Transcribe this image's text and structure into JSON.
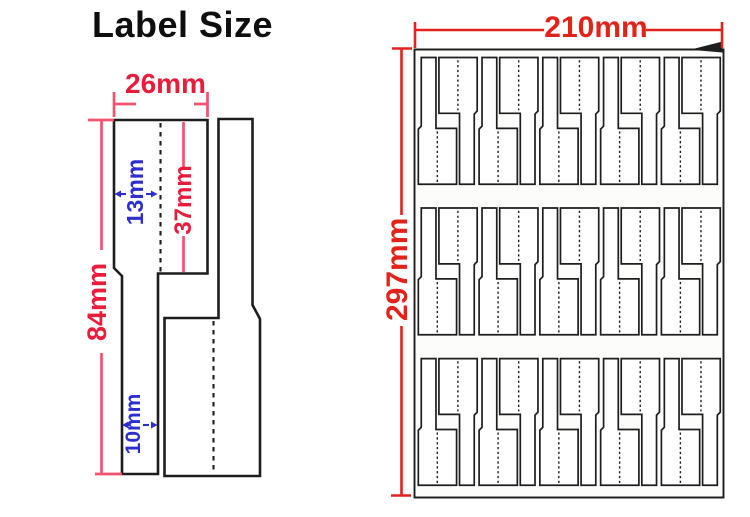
{
  "title": "Label Size",
  "colors": {
    "ink": "#1d1d1d",
    "dim_red": "#e91c3c",
    "dim_red_line": "#f2536e",
    "dim_blue": "#2e2ed0",
    "sheet_red": "#e2231a",
    "paper": "#fcfcfa"
  },
  "label_diagram": {
    "width": "26mm",
    "total_height": "84mm",
    "upper_height": "37mm",
    "fold_offset": "13mm",
    "tail_width": "10mm"
  },
  "sheet": {
    "width": "210mm",
    "height": "297mm",
    "rows": 3,
    "pairs_per_row": 5
  }
}
